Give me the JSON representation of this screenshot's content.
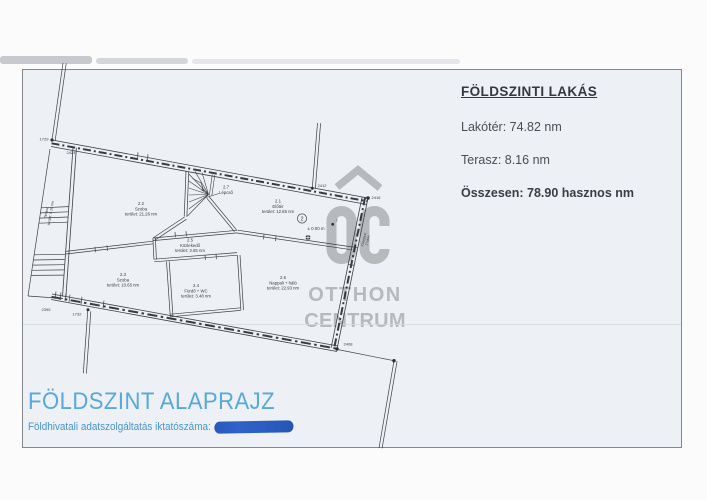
{
  "title_block": {
    "heading": "FÖLDSZINTI LAKÁS",
    "living_area": "Lakótér: 74.82 nm",
    "terrace": "Terasz: 8.16 nm",
    "total": "Összesen: 78.90 hasznos nm"
  },
  "footer": {
    "title": "FÖLDSZINT ALAPRAJZ",
    "registry_label": "Földhivatali adatszolgáltatás iktatószáma:"
  },
  "watermark": {
    "brand_line1": "OTTHON",
    "brand_line2": "CENTRUM"
  },
  "plan": {
    "rooms": [
      {
        "id": "2.2",
        "name": "Szoba",
        "area": "terület: 21.26 nm"
      },
      {
        "id": "2.7",
        "name": "Lépcső"
      },
      {
        "id": "2.1",
        "name": "Előtér",
        "area": "terület: 12.85 nm"
      },
      {
        "id": "2.5",
        "name": "Közlekedő",
        "area": "terület: 3.65 nm"
      },
      {
        "id": "2.3",
        "name": "Szoba",
        "area": "terület: 10.65 nm"
      },
      {
        "id": "2.4",
        "name": "Fürdő + WC",
        "area": "terület: 3.48 nm"
      },
      {
        "id": "2.6",
        "name": "Nappali + háló",
        "area": "terület: 22.93 nm"
      }
    ],
    "terrace_label": {
      "line1": "Terasz",
      "line2": "terület: 8.16 nm"
    },
    "entrance_label": {
      "line1": "Főbejárat",
      "line2": "2 lakás"
    },
    "level_mark": "± 0.00 m",
    "unit_badge": "2",
    "point_label": "2",
    "dimensions": [
      "1729",
      "2424",
      "2412",
      "2416",
      "2395",
      "1732",
      "2408"
    ]
  },
  "colors": {
    "accent_blue": "#58a9d9",
    "registry_blue": "#4496cd",
    "redaction_blue": "#2c5ec2",
    "watermark_gray": "#b7babd",
    "line_dark": "#3b4046"
  }
}
